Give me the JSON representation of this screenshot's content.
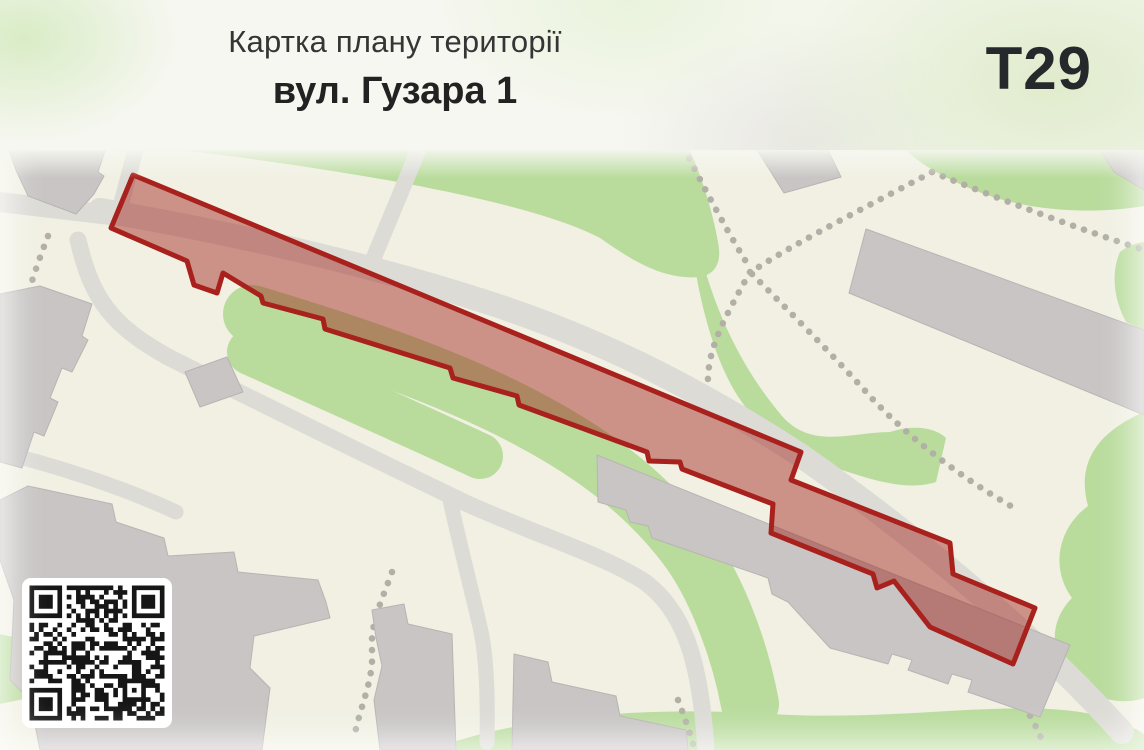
{
  "header": {
    "title": "Картка плану території",
    "subtitle": "вул. Гузара 1",
    "badge": "Т29"
  },
  "map": {
    "parcel_points": [
      [
        133,
        175
      ],
      [
        801,
        452
      ],
      [
        791,
        480
      ],
      [
        950,
        543
      ],
      [
        953,
        574
      ],
      [
        1035,
        608
      ],
      [
        1013,
        664
      ],
      [
        930,
        627
      ],
      [
        894,
        581
      ],
      [
        877,
        588
      ],
      [
        873,
        574
      ],
      [
        771,
        533
      ],
      [
        773,
        504
      ],
      [
        682,
        469
      ],
      [
        680,
        462
      ],
      [
        649,
        461
      ],
      [
        647,
        452
      ],
      [
        519,
        405
      ],
      [
        517,
        396
      ],
      [
        453,
        378
      ],
      [
        450,
        368
      ],
      [
        325,
        329
      ],
      [
        323,
        319
      ],
      [
        263,
        303
      ],
      [
        261,
        296
      ],
      [
        223,
        273
      ],
      [
        217,
        293
      ],
      [
        194,
        285
      ],
      [
        187,
        261
      ],
      [
        111,
        228
      ]
    ]
  },
  "theme": {
    "map_bg": "#f1f0e3",
    "green": "#b9dc9d",
    "road": "#dcdbd6",
    "building": "#c8c5c4",
    "building_stroke": "#b7b4b3",
    "footpath_dots": "#b1afa6",
    "parcel_stroke": "#a8211c",
    "parcel_fill": "rgba(160,30,25,0.45)",
    "qr_dark": "#161616"
  }
}
